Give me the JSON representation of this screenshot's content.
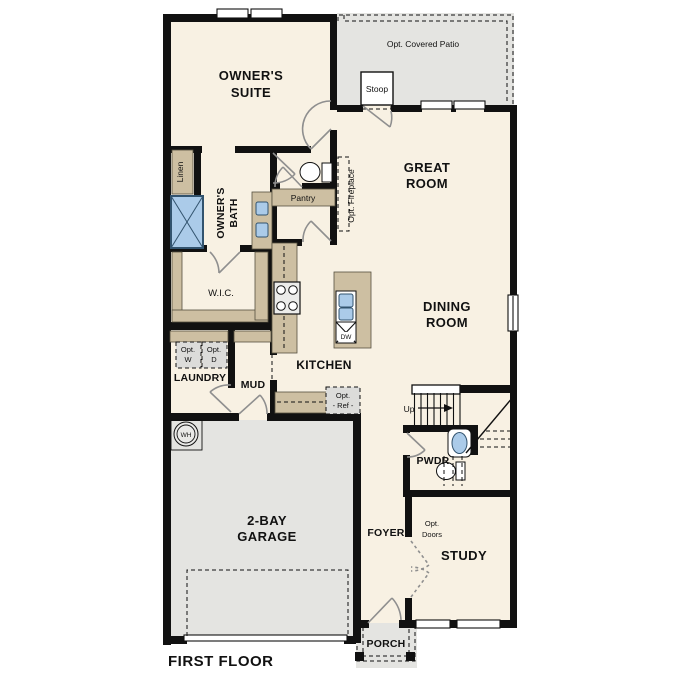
{
  "title": "FIRST FLOOR",
  "colors": {
    "floor_cream": "#f8f1e3",
    "exterior_gray": "#e4e4e1",
    "cabinet_tan": "#cdbfa2",
    "fixture_blue": "#abcbe9",
    "wall_black": "#111111"
  },
  "rooms": {
    "owners_suite": {
      "line1": "OWNER'S",
      "line2": "SUITE"
    },
    "great_room": {
      "line1": "GREAT",
      "line2": "ROOM"
    },
    "dining_room": {
      "line1": "DINING",
      "line2": "ROOM"
    },
    "kitchen": {
      "label": "KITCHEN"
    },
    "owners_bath": {
      "line1": "OWNER'S",
      "line2": "BATH"
    },
    "wic": {
      "label": "W.I.C."
    },
    "laundry": {
      "label": "LAUNDRY"
    },
    "mud": {
      "label": "MUD"
    },
    "garage": {
      "line1": "2-BAY",
      "line2": "GARAGE"
    },
    "pwdr": {
      "label": "PWDR"
    },
    "foyer": {
      "label": "FOYER"
    },
    "study": {
      "label": "STUDY"
    },
    "porch": {
      "label": "PORCH"
    }
  },
  "features": {
    "opt_covered_patio": "Opt. Covered Patio",
    "stoop": "Stoop",
    "opt_fireplace": "Opt. Fireplace",
    "linen": "Linen",
    "pantry": "Pantry",
    "opt_washer": {
      "line1": "Opt.",
      "line2": "W"
    },
    "opt_dryer": {
      "line1": "Opt.",
      "line2": "D"
    },
    "opt_ref": {
      "line1": "Opt.",
      "line2": "- Ref -"
    },
    "opt_doors": {
      "line1": "Opt.",
      "line2": "Doors"
    },
    "water_heater": "WH",
    "dishwasher": "DW",
    "stairs_up": "Up"
  }
}
